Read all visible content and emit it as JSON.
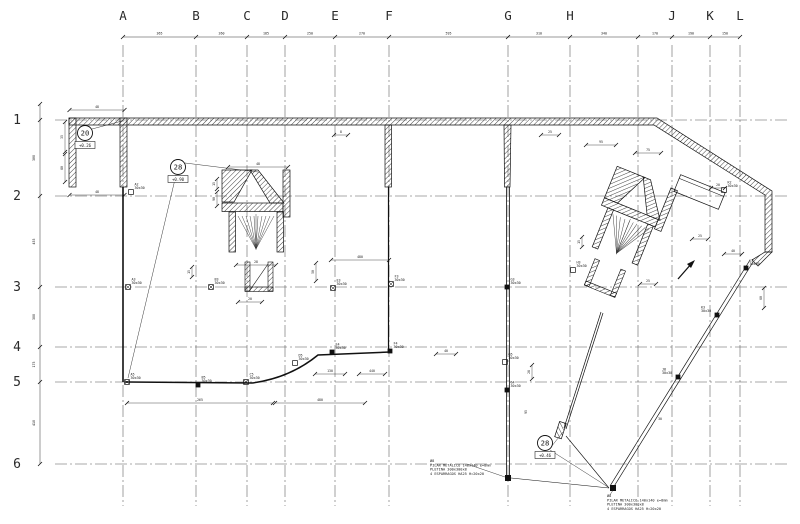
{
  "drawing": {
    "background": "#ffffff",
    "line_color": "#1a1a1a",
    "accent_color": "#111111"
  },
  "grid": {
    "columns": [
      {
        "label": "A",
        "x": 123
      },
      {
        "label": "B",
        "x": 196
      },
      {
        "label": "C",
        "x": 247
      },
      {
        "label": "D",
        "x": 285
      },
      {
        "label": "E",
        "x": 335
      },
      {
        "label": "F",
        "x": 389
      },
      {
        "label": "G",
        "x": 508
      },
      {
        "label": "H",
        "x": 570
      },
      {
        "label": "",
        "x": 638
      },
      {
        "label": "J",
        "x": 672
      },
      {
        "label": "K",
        "x": 710
      },
      {
        "label": "L",
        "x": 740
      }
    ],
    "rows": [
      {
        "label": "1",
        "y": 120
      },
      {
        "label": "2",
        "y": 196
      },
      {
        "label": "3",
        "y": 287
      },
      {
        "label": "4",
        "y": 347
      },
      {
        "label": "5",
        "y": 382
      },
      {
        "label": "6",
        "y": 464
      }
    ],
    "top_dim_y": 37,
    "left_dim_x": 40,
    "col_label_y": 20,
    "row_label_x": 17,
    "line_top": 45,
    "line_bottom": 506,
    "line_left": 55,
    "line_right": 788
  },
  "dims": {
    "top": [
      "365",
      "260",
      "185",
      "250",
      "270",
      "595",
      "310",
      "340",
      "170",
      "190",
      "150"
    ],
    "left": [
      "380",
      "455",
      "300",
      "175",
      "410"
    ],
    "misc": [
      {
        "x": 97,
        "y": 108,
        "t": "48",
        "o": "h",
        "l": 55
      },
      {
        "x": 97,
        "y": 193,
        "t": "48",
        "o": "h",
        "l": 55
      },
      {
        "x": 63,
        "y": 137,
        "t": "35",
        "o": "v",
        "l": 30
      },
      {
        "x": 63,
        "y": 168,
        "t": "80",
        "o": "v",
        "l": 28
      },
      {
        "x": 258,
        "y": 165,
        "t": "48",
        "o": "h",
        "l": 60
      },
      {
        "x": 215,
        "y": 184,
        "t": "15",
        "o": "v",
        "l": 10
      },
      {
        "x": 215,
        "y": 199,
        "t": "90",
        "o": "v",
        "l": 14
      },
      {
        "x": 256,
        "y": 263,
        "t": "28",
        "o": "h",
        "l": 40
      },
      {
        "x": 250,
        "y": 300,
        "t": "20",
        "o": "h",
        "l": 24
      },
      {
        "x": 360,
        "y": 258,
        "t": "480",
        "o": "h",
        "l": 58
      },
      {
        "x": 314,
        "y": 272,
        "t": "50",
        "o": "v",
        "l": 18
      },
      {
        "x": 190,
        "y": 272,
        "t": "15",
        "o": "v",
        "l": 10
      },
      {
        "x": 341,
        "y": 133,
        "t": "8",
        "o": "h",
        "l": 14
      },
      {
        "x": 550,
        "y": 133,
        "t": "25",
        "o": "h",
        "l": 18
      },
      {
        "x": 718,
        "y": 186,
        "t": "20",
        "o": "h",
        "l": 14
      },
      {
        "x": 700,
        "y": 237,
        "t": "25",
        "o": "h",
        "l": 16
      },
      {
        "x": 762,
        "y": 298,
        "t": "60",
        "o": "v",
        "l": 20
      },
      {
        "x": 648,
        "y": 151,
        "t": "75",
        "o": "h",
        "l": 26
      },
      {
        "x": 601,
        "y": 143,
        "t": "95",
        "o": "h",
        "l": 30
      },
      {
        "x": 330,
        "y": 372,
        "t": "130",
        "o": "h",
        "l": 30
      },
      {
        "x": 372,
        "y": 372,
        "t": "440",
        "o": "h",
        "l": 26
      },
      {
        "x": 200,
        "y": 401,
        "t": "265",
        "o": "h",
        "l": 146
      },
      {
        "x": 320,
        "y": 401,
        "t": "480",
        "o": "h",
        "l": 90
      },
      {
        "x": 446,
        "y": 352,
        "t": "40",
        "o": "h",
        "l": 20
      },
      {
        "x": 530,
        "y": 372,
        "t": "28",
        "o": "v",
        "l": 14
      },
      {
        "x": 527,
        "y": 412,
        "t": "95",
        "o": "v",
        "l": 0
      },
      {
        "x": 660,
        "y": 420,
        "t": "30",
        "o": "h",
        "l": 0
      },
      {
        "x": 733,
        "y": 252,
        "t": "40",
        "o": "h",
        "l": 18
      },
      {
        "x": 648,
        "y": 282,
        "t": "25",
        "o": "h",
        "l": 16
      },
      {
        "x": 580,
        "y": 242,
        "t": "15",
        "o": "v",
        "l": 10
      }
    ]
  },
  "markers": [
    {
      "num": "20",
      "x": 85,
      "y": 133,
      "level": "+0.26",
      "leaders": [
        [
          92,
          129,
          122,
          121
        ]
      ]
    },
    {
      "num": "28",
      "x": 178,
      "y": 167,
      "level": "+0.90",
      "leaders": [
        [
          185,
          163,
          258,
          172
        ],
        [
          176,
          175,
          128,
          378
        ]
      ]
    },
    {
      "num": "28",
      "x": 545,
      "y": 443,
      "level": "+0.46",
      "leaders": [
        [
          551,
          447,
          563,
          432
        ],
        [
          550,
          450,
          608,
          487
        ]
      ]
    }
  ],
  "columns_schedule": [
    {
      "id": "A2",
      "size": "30x30",
      "x": 131,
      "y": 192,
      "style": "hollow"
    },
    {
      "id": "K2",
      "size": "30x30",
      "x": 724,
      "y": 190,
      "style": "hollow"
    },
    {
      "id": "A3",
      "size": "30x30",
      "x": 128,
      "y": 287,
      "style": "x"
    },
    {
      "id": "B3",
      "size": "30x30",
      "x": 211,
      "y": 287,
      "style": "x"
    },
    {
      "id": "E3",
      "size": "30x30",
      "x": 333,
      "y": 288,
      "style": "x"
    },
    {
      "id": "F3",
      "size": "30x30",
      "x": 391,
      "y": 284,
      "style": "x"
    },
    {
      "id": "G3",
      "size": "30x30",
      "x": 507,
      "y": 287,
      "style": "filled"
    },
    {
      "id": "H3",
      "size": "30x30",
      "x": 573,
      "y": 270,
      "style": "hollow"
    },
    {
      "id": "L3",
      "size": "30x30",
      "x": 746,
      "y": 268,
      "style": "filled"
    },
    {
      "id": "K3",
      "size": "30x30",
      "x": 717,
      "y": 315,
      "style": "filled",
      "ldx": -16
    },
    {
      "id": "J8",
      "size": "30x30",
      "x": 678,
      "y": 377,
      "style": "filled",
      "ldx": -16
    },
    {
      "id": "E4",
      "size": "30x30",
      "x": 332,
      "y": 352,
      "style": "filled"
    },
    {
      "id": "F4",
      "size": "30x30",
      "x": 390,
      "y": 351,
      "style": "filled"
    },
    {
      "id": "G5",
      "size": "30x30",
      "x": 505,
      "y": 362,
      "style": "hollow"
    },
    {
      "id": "G4",
      "size": "30x30",
      "x": 507,
      "y": 390,
      "style": "filled"
    },
    {
      "id": "D5",
      "size": "30x30",
      "x": 295,
      "y": 363,
      "style": "hollow"
    },
    {
      "id": "C5",
      "size": "30x30",
      "x": 246,
      "y": 382,
      "style": "x"
    },
    {
      "id": "B5",
      "size": "30x30",
      "x": 198,
      "y": 385,
      "style": "filled"
    },
    {
      "id": "A5",
      "size": "30x30",
      "x": 127,
      "y": 382,
      "style": "x"
    },
    {
      "id": "",
      "size": "",
      "x": 508,
      "y": 478,
      "style": "filled"
    },
    {
      "id": "",
      "size": "",
      "x": 613,
      "y": 488,
      "style": "filled"
    }
  ],
  "notes": [
    {
      "x": 430,
      "y": 462,
      "leader": [
        467,
        464,
        505,
        477
      ],
      "lines": [
        "Ø8",
        "PILAR METALICO 140x140 e=8mm",
        "PLETINA 300x300x8",
        "4 ESPARRAGOS HA25 H=20x20"
      ]
    },
    {
      "x": 607,
      "y": 497,
      "leader": [
        610,
        495,
        613,
        490
      ],
      "lines": [
        "Ø8",
        "PILAR METALICO 140x140 e=8mm",
        "PLETINA 300x300x8",
        "4 ESPARRAGOS HA25 H=20x20"
      ]
    }
  ]
}
